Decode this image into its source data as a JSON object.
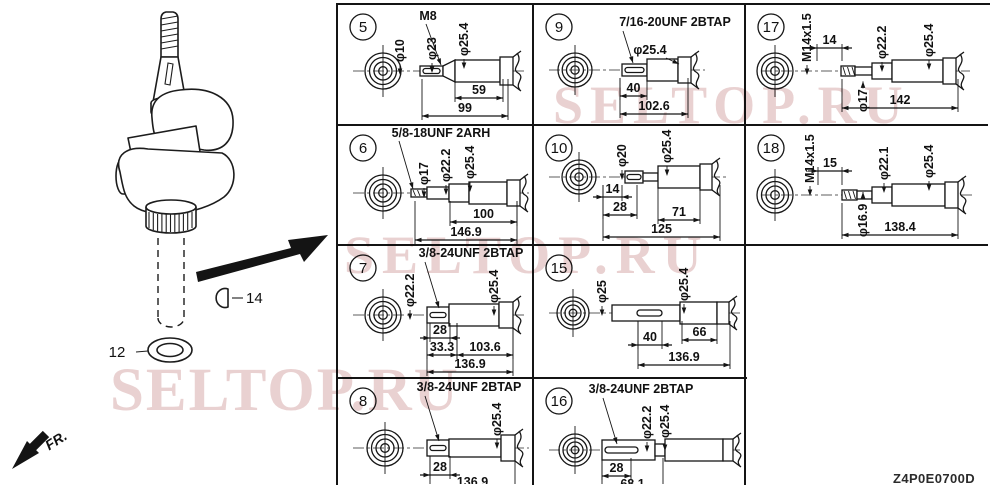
{
  "drawing_code": "Z4P0E0700D",
  "watermark": {
    "text": "SELTOP.RU",
    "color": "#cb9292"
  },
  "figure": {
    "front_label": "FR.",
    "callouts": [
      {
        "label": "12",
        "part": "washer"
      },
      {
        "label": "14",
        "part": "woodruff-key"
      }
    ]
  },
  "table": {
    "columns_x": [
      337,
      533,
      745
    ],
    "column_widths": [
      196,
      212,
      245
    ],
    "rows_y": [
      3,
      124,
      244,
      377
    ],
    "row_heights": [
      121,
      120,
      133,
      106
    ],
    "cells": [
      {
        "num": "5",
        "col": 0,
        "row": 0,
        "end": {
          "cx": 46,
          "cy": 67,
          "r": 18
        },
        "shaft": {
          "cy": 67,
          "segs": [
            [
              83,
              106,
              5
            ],
            [
              106,
              118,
              11,
              "t"
            ],
            [
              118,
              163,
              11
            ]
          ],
          "flange": [
            163,
            176,
            14
          ],
          "slot": [
            86,
            103,
            2.5
          ]
        },
        "thread": {
          "t": "M8",
          "x": 91,
          "y": 16,
          "leader": [
            89,
            20,
            104,
            61
          ]
        },
        "dias": [
          {
            "t": "φ10",
            "x": 63,
            "y": 58
          },
          {
            "t": "φ23",
            "x": 95,
            "y": 56
          },
          {
            "t": "φ25.4",
            "x": 127,
            "y": 52
          }
        ],
        "lens": [
          {
            "t": "59",
            "x1": 118,
            "x2": 166,
            "y": 94
          },
          {
            "t": "99",
            "x1": 85,
            "x2": 171,
            "y": 112
          }
        ]
      },
      {
        "num": "9",
        "col": 1,
        "row": 0,
        "end": {
          "cx": 42,
          "cy": 66,
          "r": 17
        },
        "shaft": {
          "cy": 66,
          "segs": [
            [
              89,
              114,
              6
            ],
            [
              114,
              145,
              11
            ]
          ],
          "flange": [
            145,
            158,
            13
          ],
          "slot": [
            92,
            111,
            2.5
          ]
        },
        "thread": {
          "t": "7/16-20UNF 2BTAP",
          "x": 142,
          "y": 22,
          "leader": [
            90,
            27,
            100,
            59
          ]
        },
        "dias": [
          {
            "t": "φ25.4",
            "x": 117,
            "y": 50,
            "rot": 0,
            "leader": [
              133,
              54,
              146,
              60
            ]
          }
        ],
        "lens": [
          {
            "t": "40",
            "x1": 87,
            "x2": 114,
            "y": 92
          },
          {
            "t": "102.6",
            "x1": 87,
            "x2": 155,
            "y": 110
          }
        ]
      },
      {
        "num": "17",
        "col": 2,
        "row": 0,
        "end": {
          "cx": 30,
          "cy": 67,
          "r": 18
        },
        "shaft": {
          "cy": 67,
          "segs": [
            [
              96,
              110,
              5
            ],
            [
              110,
              127,
              4
            ],
            [
              127,
              147,
              8
            ],
            [
              147,
              198,
              11
            ]
          ],
          "flange": [
            198,
            211,
            13
          ],
          "hatch": true
        },
        "thread": {
          "t": "M14x1.5",
          "x": 62,
          "y": 58,
          "rot": -90
        },
        "dias": [
          {
            "t": "φ22.2",
            "x": 137,
            "y": 55
          },
          {
            "t": "φ25.4",
            "x": 184,
            "y": 53
          },
          {
            "t": "φ17",
            "x": 118,
            "y": 108,
            "below": true
          }
        ],
        "lens": [
          {
            "t": "14",
            "x1": 72,
            "x2": 97,
            "y": 44
          },
          {
            "t": "142",
            "x1": 97,
            "x2": 213,
            "y": 104
          }
        ]
      },
      {
        "num": "6",
        "col": 0,
        "row": 1,
        "end": {
          "cx": 46,
          "cy": 68,
          "r": 18
        },
        "shaft": {
          "cy": 68,
          "segs": [
            [
              74,
              90,
              4
            ],
            [
              90,
              112,
              6
            ],
            [
              112,
              132,
              9
            ],
            [
              132,
              170,
              11
            ]
          ],
          "flange": [
            170,
            183,
            13
          ],
          "hatch": true
        },
        "thread": {
          "t": "5/8-18UNF 2ARH",
          "x": 104,
          "y": 12,
          "leader": [
            62,
            16,
            76,
            64
          ]
        },
        "dias": [
          {
            "t": "φ17",
            "x": 87,
            "y": 60
          },
          {
            "t": "φ22.2",
            "x": 109,
            "y": 57
          },
          {
            "t": "φ25.4",
            "x": 133,
            "y": 54
          }
        ],
        "lens": [
          {
            "t": "100",
            "x1": 113,
            "x2": 180,
            "y": 97
          },
          {
            "t": "146.9",
            "x1": 78,
            "x2": 180,
            "y": 115
          }
        ]
      },
      {
        "num": "10",
        "col": 1,
        "row": 1,
        "end": {
          "cx": 46,
          "cy": 52,
          "r": 17
        },
        "shaft": {
          "cy": 52,
          "segs": [
            [
              92,
              110,
              6
            ],
            [
              110,
              125,
              4
            ],
            [
              125,
              167,
              11
            ]
          ],
          "flange": [
            167,
            179,
            13
          ],
          "slot": [
            94,
            108,
            2.5
          ]
        },
        "dias": [
          {
            "t": "φ20",
            "x": 89,
            "y": 42
          },
          {
            "t": "φ25.4",
            "x": 134,
            "y": 38
          }
        ],
        "lens": [
          {
            "t": "14",
            "x1": 70,
            "x2": 89,
            "y": 72
          },
          {
            "t": "28",
            "x1": 70,
            "x2": 104,
            "y": 90
          },
          {
            "t": "71",
            "x1": 125,
            "x2": 167,
            "y": 95
          },
          {
            "t": "125",
            "x1": 70,
            "x2": 187,
            "y": 112
          }
        ]
      },
      {
        "num": "18",
        "col": 2,
        "row": 1,
        "end": {
          "cx": 30,
          "cy": 70,
          "r": 18
        },
        "shaft": {
          "cy": 70,
          "segs": [
            [
              97,
              112,
              5
            ],
            [
              112,
              127,
              4
            ],
            [
              127,
              147,
              8
            ],
            [
              147,
              200,
              11
            ]
          ],
          "flange": [
            200,
            213,
            13
          ],
          "hatch": true
        },
        "thread": {
          "t": "M14x1.5",
          "x": 65,
          "y": 58,
          "rot": -90
        },
        "dias": [
          {
            "t": "φ22.1",
            "x": 139,
            "y": 55
          },
          {
            "t": "φ25.4",
            "x": 184,
            "y": 53
          },
          {
            "t": "φ16.9",
            "x": 118,
            "y": 112,
            "below": true
          }
        ],
        "lens": [
          {
            "t": "15",
            "x1": 73,
            "x2": 97,
            "y": 46
          },
          {
            "t": "138.4",
            "x1": 97,
            "x2": 213,
            "y": 110
          }
        ]
      },
      {
        "num": "7",
        "col": 0,
        "row": 2,
        "end": {
          "cx": 46,
          "cy": 70,
          "r": 18
        },
        "shaft": {
          "cy": 70,
          "segs": [
            [
              90,
              112,
              8
            ],
            [
              112,
              162,
              11
            ]
          ],
          "flange": [
            162,
            176,
            13
          ],
          "slot": [
            93,
            109,
            2.5
          ]
        },
        "thread": {
          "t": "3/8-24UNF 2BTAP",
          "x": 134,
          "y": 12,
          "leader": [
            88,
            17,
            102,
            63
          ]
        },
        "dias": [
          {
            "t": "φ22.2",
            "x": 73,
            "y": 62
          },
          {
            "t": "φ25.4",
            "x": 157,
            "y": 58
          }
        ],
        "lens": [
          {
            "t": "28",
            "x1": 93,
            "x2": 113,
            "y": 93
          },
          {
            "t": "33.3",
            "x1": 90,
            "x2": 120,
            "y": 110
          },
          {
            "t": "103.6",
            "x1": 120,
            "x2": 176,
            "y": 110
          },
          {
            "t": "136.9",
            "x1": 90,
            "x2": 176,
            "y": 127
          }
        ]
      },
      {
        "num": "15",
        "col": 1,
        "row": 2,
        "end": {
          "cx": 40,
          "cy": 68,
          "r": 16
        },
        "shaft": {
          "cy": 68,
          "segs": [
            [
              79,
              147,
              8
            ],
            [
              147,
              184,
              11
            ]
          ],
          "flange": [
            184,
            196,
            11
          ],
          "slot": [
            104,
            129,
            3
          ]
        },
        "dias": [
          {
            "t": "φ25",
            "x": 69,
            "y": 58
          },
          {
            "t": "φ25.4",
            "x": 151,
            "y": 56
          }
        ],
        "lens": [
          {
            "t": "40",
            "x1": 105,
            "x2": 129,
            "y": 100
          },
          {
            "t": "66",
            "x1": 149,
            "x2": 184,
            "y": 95
          },
          {
            "t": "136.9",
            "x1": 105,
            "x2": 197,
            "y": 120
          }
        ]
      },
      {
        "num": "8",
        "col": 0,
        "row": 3,
        "end": {
          "cx": 48,
          "cy": 70,
          "r": 18
        },
        "shaft": {
          "cy": 70,
          "segs": [
            [
              90,
              112,
              8
            ],
            [
              112,
              164,
              9
            ]
          ],
          "flange": [
            164,
            178,
            13
          ],
          "slot": [
            93,
            109,
            2.5
          ]
        },
        "thread": {
          "t": "3/8-24UNF 2BTAP",
          "x": 132,
          "y": 13,
          "leader": [
            88,
            18,
            102,
            63
          ]
        },
        "dias": [
          {
            "t": "φ25.4",
            "x": 160,
            "y": 58
          }
        ],
        "lens": [
          {
            "t": "28",
            "x1": 93,
            "x2": 113,
            "y": 97
          },
          {
            "t": "136.9",
            "x1": 93,
            "x2": 178,
            "y": 112
          }
        ]
      },
      {
        "num": "16",
        "col": 1,
        "row": 3,
        "end": {
          "cx": 42,
          "cy": 72,
          "r": 16
        },
        "shaft": {
          "cy": 72,
          "segs": [
            [
              69,
              122,
              10
            ],
            [
              122,
              132,
              6
            ],
            [
              132,
              190,
              11
            ]
          ],
          "flange": [
            190,
            200,
            11
          ],
          "slot": [
            72,
            105,
            3
          ]
        },
        "thread": {
          "t": "3/8-24UNF 2BTAP",
          "x": 108,
          "y": 15,
          "leader": [
            70,
            20,
            84,
            66
          ]
        },
        "dias": [
          {
            "t": "φ22.2",
            "x": 114,
            "y": 61
          },
          {
            "t": "φ25.4",
            "x": 132,
            "y": 60
          }
        ],
        "lens": [
          {
            "t": "28",
            "x1": 69,
            "x2": 98,
            "y": 98
          },
          {
            "t": "68.1",
            "x1": 69,
            "x2": 130,
            "y": 114
          }
        ]
      }
    ]
  }
}
